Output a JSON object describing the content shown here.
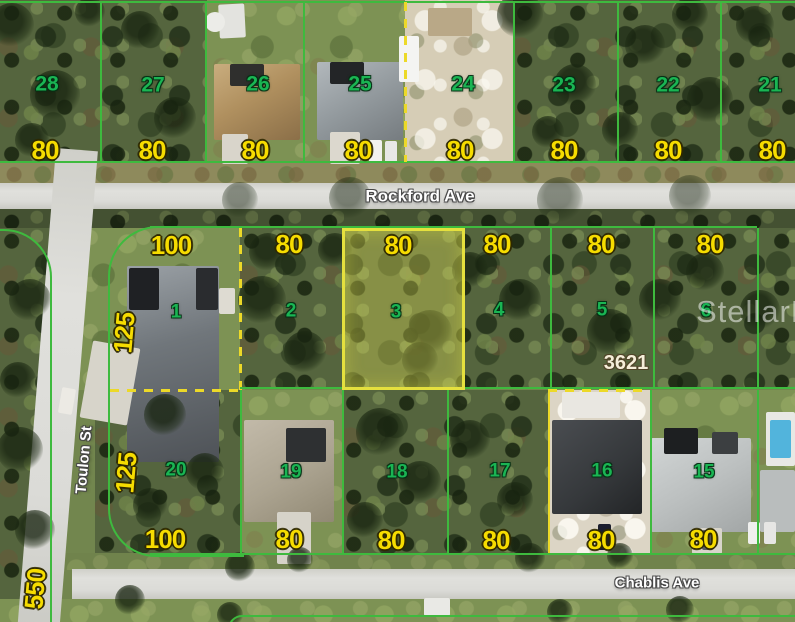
{
  "streets": {
    "rockford": "Rockford Ave",
    "toulon": "Toulon St",
    "chablis": "Chablis Ave"
  },
  "watermark": "StellarMLS",
  "address_label": "3621",
  "west_parcel_dim": "550",
  "top_row": [
    {
      "lot": "28",
      "dim": "80"
    },
    {
      "lot": "27",
      "dim": "80"
    },
    {
      "lot": "26",
      "dim": "80"
    },
    {
      "lot": "25",
      "dim": "80"
    },
    {
      "lot": "24",
      "dim": "80"
    },
    {
      "lot": "23",
      "dim": "80"
    },
    {
      "lot": "22",
      "dim": "80"
    },
    {
      "lot": "21",
      "dim": "80"
    }
  ],
  "middle_row": [
    {
      "lot": "1",
      "front": "100",
      "side": "125"
    },
    {
      "lot": "2",
      "front": "80"
    },
    {
      "lot": "3",
      "front": "80",
      "highlighted": true
    },
    {
      "lot": "4",
      "front": "80"
    },
    {
      "lot": "5",
      "front": "80"
    },
    {
      "lot": "6",
      "front": "80"
    }
  ],
  "bottom_row": [
    {
      "lot": "20",
      "front": "100",
      "side": "125"
    },
    {
      "lot": "19",
      "front": "80"
    },
    {
      "lot": "18",
      "front": "80"
    },
    {
      "lot": "17",
      "front": "80"
    },
    {
      "lot": "16",
      "front": "80"
    },
    {
      "lot": "15",
      "front": "80"
    }
  ],
  "colors": {
    "parcel_line": "#3eba3e",
    "lot_number": "#1ab553",
    "dimension": "#f6dc00",
    "highlight": "#e5e03e",
    "dash": "#ecd928",
    "street_label": "#ffffff"
  }
}
